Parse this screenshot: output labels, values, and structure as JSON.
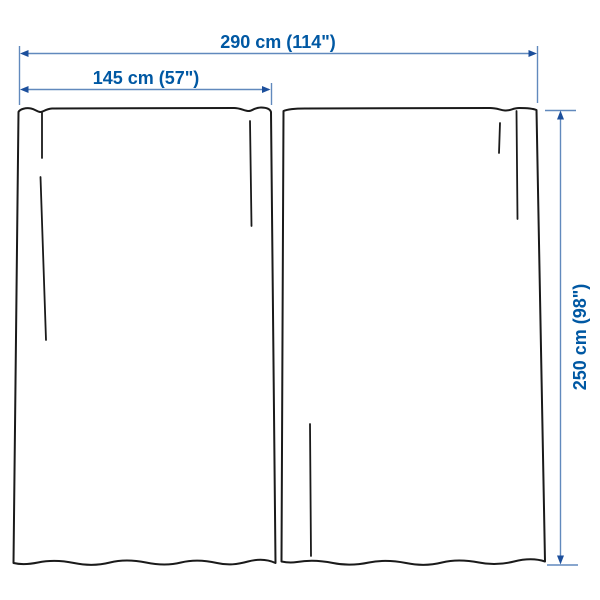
{
  "diagram": {
    "title": "curtain-panels-dimension-diagram",
    "panel_count": 2,
    "colors": {
      "dimension_text": "#0058a3",
      "dimension_line": "#6189bd",
      "dimension_arrow": "#1c4f9c",
      "curtain_outline": "#1a1a1a",
      "background": "#ffffff"
    },
    "dimensions": {
      "total_width": {
        "label": "290 cm (114\")"
      },
      "panel_width": {
        "label": "145 cm (57\")"
      },
      "panel_height": {
        "label": "250 cm (98\")"
      }
    }
  }
}
